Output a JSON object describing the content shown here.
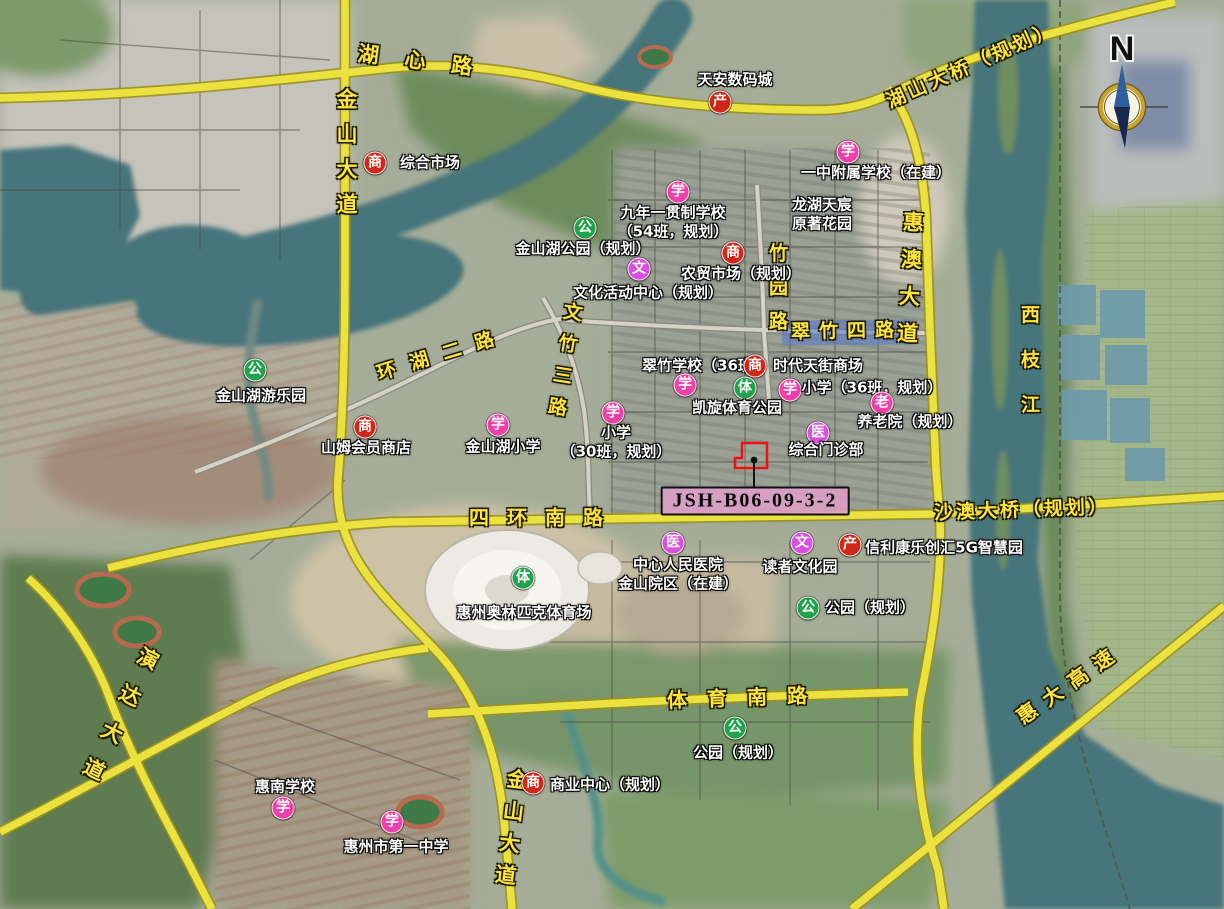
{
  "parcel": {
    "id_label": "JSH-B06-09-3-2",
    "outline_color": "#f01010",
    "label_bg": "#e09ecb"
  },
  "compass": {
    "label": "N"
  },
  "colors": {
    "road_yellow": "#ece23f",
    "road_label_yellow": "#ffe33e",
    "water_teal": "#47757c",
    "highlight_road_blue": "#5577cc",
    "marker_commerce_red": "#d02818",
    "marker_school_pink": "#ef3fa8",
    "marker_park_green": "#21a34c",
    "marker_culture_violet": "#d94fe0"
  },
  "pois": [
    {
      "glyph": "商",
      "color": "#d02818",
      "x": 375,
      "y": 163,
      "label": "综合市场",
      "lx": 430,
      "ly": 163
    },
    {
      "glyph": "产",
      "color": "#d02818",
      "x": 720,
      "y": 102,
      "label": "天安数码城",
      "lx": 735,
      "ly": 80
    },
    {
      "glyph": "学",
      "color": "#ef3fa8",
      "x": 848,
      "y": 152,
      "label": "一中附属学校（在建）",
      "lx": 876,
      "ly": 173
    },
    {
      "glyph": null,
      "color": null,
      "x": 0,
      "y": 0,
      "label": "龙湖天宸\n原著花园",
      "lx": 822,
      "ly": 214
    },
    {
      "glyph": "学",
      "color": "#ef3fa8",
      "x": 678,
      "y": 192,
      "label": "九年一贯制学校\n（54班，规划）",
      "lx": 673,
      "ly": 222
    },
    {
      "glyph": "公",
      "color": "#21a34c",
      "x": 585,
      "y": 228,
      "label": "金山湖公园（规划）",
      "lx": 583,
      "ly": 249
    },
    {
      "glyph": "文",
      "color": "#d94fe0",
      "x": 639,
      "y": 269,
      "label": "文化活动中心（规划）",
      "lx": 648,
      "ly": 293
    },
    {
      "glyph": "商",
      "color": "#d02818",
      "x": 733,
      "y": 253,
      "label": "农贸市场（规划）",
      "lx": 741,
      "ly": 274
    },
    {
      "glyph": "学",
      "color": "#ef3fa8",
      "x": 685,
      "y": 385,
      "label": "翠竹学校（36班）",
      "lx": 705,
      "ly": 366
    },
    {
      "glyph": "商",
      "color": "#d02818",
      "x": 755,
      "y": 366,
      "label": "时代天街商场",
      "lx": 818,
      "ly": 366
    },
    {
      "glyph": "体",
      "color": "#21a34c",
      "x": 745,
      "y": 388,
      "label": "凯旋体育公园",
      "lx": 737,
      "ly": 408
    },
    {
      "glyph": "学",
      "color": "#ef3fa8",
      "x": 790,
      "y": 390,
      "label": "小学（36班，规划）",
      "lx": 872,
      "ly": 388
    },
    {
      "glyph": "老",
      "color": "#ef3fa8",
      "x": 882,
      "y": 403,
      "label": "养老院（规划）",
      "lx": 910,
      "ly": 422
    },
    {
      "glyph": "医",
      "color": "#d94fe0",
      "x": 818,
      "y": 433,
      "label": "综合门诊部",
      "lx": 826,
      "ly": 450
    },
    {
      "glyph": "学",
      "color": "#ef3fa8",
      "x": 613,
      "y": 413,
      "label": "小学\n（30班，规划）",
      "lx": 616,
      "ly": 442
    },
    {
      "glyph": "公",
      "color": "#21a34c",
      "x": 255,
      "y": 370,
      "label": "金山湖游乐园",
      "lx": 261,
      "ly": 396
    },
    {
      "glyph": "商",
      "color": "#d02818",
      "x": 365,
      "y": 427,
      "label": "山姆会员商店",
      "lx": 366,
      "ly": 448
    },
    {
      "glyph": "学",
      "color": "#ef3fa8",
      "x": 498,
      "y": 425,
      "label": "金山湖小学",
      "lx": 503,
      "ly": 447
    },
    {
      "glyph": "医",
      "color": "#d94fe0",
      "x": 673,
      "y": 543,
      "label": "中心人民医院\n金山院区（在建）",
      "lx": 678,
      "ly": 574
    },
    {
      "glyph": "文",
      "color": "#d94fe0",
      "x": 802,
      "y": 543,
      "label": "读者文化园",
      "lx": 800,
      "ly": 567
    },
    {
      "glyph": "产",
      "color": "#d02818",
      "x": 850,
      "y": 545,
      "label": "信利康乐创汇5G智慧园",
      "lx": 944,
      "ly": 548
    },
    {
      "glyph": "公",
      "color": "#21a34c",
      "x": 808,
      "y": 608,
      "label": "公园（规划）",
      "lx": 870,
      "ly": 608
    },
    {
      "glyph": "体",
      "color": "#21a34c",
      "x": 523,
      "y": 578,
      "label": "惠州奥林匹克体育场",
      "lx": 524,
      "ly": 613
    },
    {
      "glyph": "公",
      "color": "#21a34c",
      "x": 735,
      "y": 728,
      "label": "公园（规划）",
      "lx": 738,
      "ly": 753
    },
    {
      "glyph": "商",
      "color": "#d02818",
      "x": 533,
      "y": 783,
      "label": "商业中心（规划）",
      "lx": 610,
      "ly": 785
    },
    {
      "glyph": "学",
      "color": "#ef3fa8",
      "x": 283,
      "y": 808,
      "label": "惠南学校",
      "lx": 285,
      "ly": 787
    },
    {
      "glyph": "学",
      "color": "#ef3fa8",
      "x": 392,
      "y": 822,
      "label": "惠州市第一中学",
      "lx": 396,
      "ly": 847
    }
  ],
  "road_labels": [
    {
      "text": "湖心路",
      "x": 428,
      "y": 62,
      "rot": 7,
      "spacing": 26,
      "size": 21,
      "vertical": false
    },
    {
      "text": "湖山大桥（规划）",
      "x": 972,
      "y": 66,
      "rot": -24,
      "spacing": 4,
      "size": 19,
      "vertical": false
    },
    {
      "text": "金山大道",
      "x": 346,
      "y": 158,
      "rot": 0,
      "spacing": 14,
      "size": 21,
      "vertical": true
    },
    {
      "text": "惠澳大道",
      "x": 909,
      "y": 285,
      "rot": 3,
      "spacing": 16,
      "size": 21,
      "vertical": true
    },
    {
      "text": "竹园路",
      "x": 776,
      "y": 294,
      "rot": 0,
      "spacing": 15,
      "size": 19,
      "vertical": true
    },
    {
      "text": "翠竹四路",
      "x": 847,
      "y": 332,
      "rot": -1,
      "spacing": 9,
      "size": 19,
      "vertical": false
    },
    {
      "text": "环湖二路",
      "x": 443,
      "y": 355,
      "rot": -17,
      "spacing": 15,
      "size": 19,
      "vertical": false
    },
    {
      "text": "文竹三路",
      "x": 562,
      "y": 365,
      "rot": 9,
      "spacing": 13,
      "size": 19,
      "vertical": true
    },
    {
      "text": "四环南路",
      "x": 545,
      "y": 518,
      "rot": 0,
      "spacing": 18,
      "size": 20,
      "vertical": false
    },
    {
      "text": "沙澳大桥（规划）",
      "x": 1022,
      "y": 511,
      "rot": -2,
      "spacing": 3,
      "size": 19,
      "vertical": false
    },
    {
      "text": "西枝江",
      "x": 1028,
      "y": 372,
      "rot": 0,
      "spacing": 26,
      "size": 19,
      "vertical": true
    },
    {
      "text": "体育南路",
      "x": 747,
      "y": 698,
      "rot": -2,
      "spacing": 20,
      "size": 20,
      "vertical": false
    },
    {
      "text": "金山大道",
      "x": 510,
      "y": 832,
      "rot": 7,
      "spacing": 11,
      "size": 21,
      "vertical": true
    },
    {
      "text": "演达大道",
      "x": 116,
      "y": 722,
      "rot": 26,
      "spacing": 20,
      "size": 21,
      "vertical": true
    },
    {
      "text": "惠大高速",
      "x": 1070,
      "y": 684,
      "rot": -35,
      "spacing": 11,
      "size": 20,
      "vertical": false
    }
  ]
}
